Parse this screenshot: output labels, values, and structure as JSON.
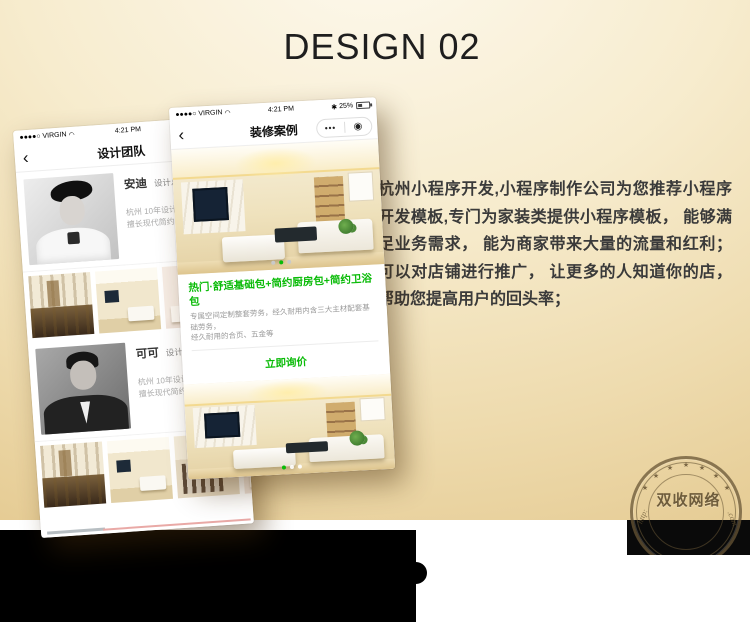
{
  "colors": {
    "accent_green": "#09bb07",
    "bg_top": "#fdf9ee",
    "bg_bottom": "#e3c78c",
    "band_black": "#000000"
  },
  "page": {
    "title": "DESIGN 02",
    "description": "杭州小程序开发,小程序制作公司为您推荐小程序开发模板,专门为家装类提供小程序模板， 能够满足业务需求， 能为商家带来大量的流量和红利； 可以对店铺进行推广， 让更多的人知道你的店， 帮助您提高用户的回头率；"
  },
  "icons": {
    "wifi": "◠",
    "bluetooth": "✱",
    "star": "★",
    "back_chevron": "‹",
    "capsule_more": "•••",
    "capsule_close": "◉"
  },
  "phone_front": {
    "status": {
      "carrier": "●●●●○ VIRGIN",
      "time": "4:21 PM",
      "battery_pct": "25%"
    },
    "nav": {
      "title": "装修案例"
    },
    "card": {
      "title": "热门·舒适基础包+简约厨房包+简约卫浴包",
      "desc_line1": "专属空间定制整套劳务，经久耐用内含三大主材配套基础劳务，",
      "desc_line2": "经久耐用的合页、五金等",
      "button": "立即询价"
    }
  },
  "phone_back": {
    "status": {
      "carrier": "●●●●○ VIRGIN",
      "time": "4:21 PM",
      "battery_pct": "25%"
    },
    "nav": {
      "title": "设计团队"
    },
    "designers": [
      {
        "name": "安迪",
        "role": "设计总监",
        "line1": "杭州 10年设计经验",
        "line2": "擅长现代简约风格"
      },
      {
        "name": "可可",
        "role": "设计总监",
        "line1": "杭州 10年设计经验",
        "line2": "擅长现代简约风格"
      }
    ]
  },
  "stamp": {
    "text": "双收网络",
    "curve_left": "http:",
    "curve_right": ".com"
  }
}
